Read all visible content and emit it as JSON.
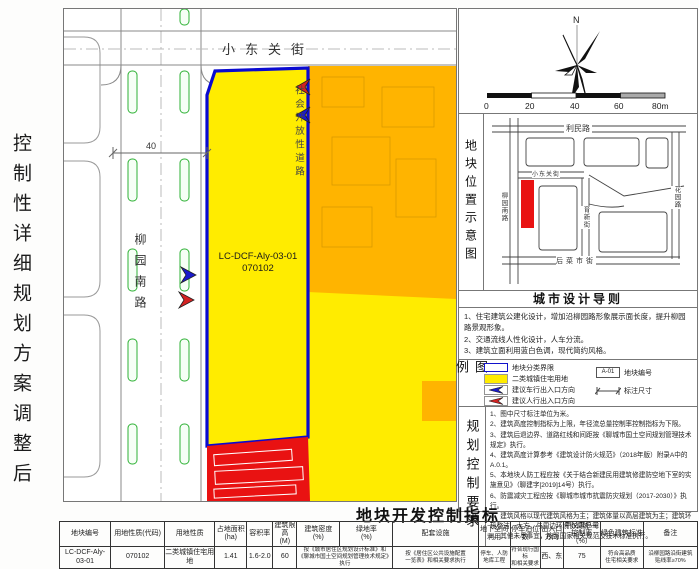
{
  "side_title": "控制性详细规划方案调整后",
  "map": {
    "street_top": "小东关街",
    "road_left": "柳园南路",
    "road_open": "社会开放性道路",
    "parcel_code": "LC-DCF-Aly-03-01",
    "parcel_subcode": "070102",
    "dimension": "40"
  },
  "compass": {
    "north": "N",
    "scale_ticks": [
      "0",
      "20",
      "40",
      "60",
      "80m"
    ]
  },
  "location_map": {
    "section_title": "地块位置示意图",
    "roads": {
      "limin": "利民路",
      "liuyuan": "柳园南路",
      "xiaodongguan": "小东关街",
      "yuxin": "育新街",
      "huayuan": "花园路",
      "houcaishi": "后菜市街"
    }
  },
  "design_guidelines": {
    "title": "城市设计导则",
    "items": [
      "1、住宅建筑公建化设计，增加沿柳园路形象展示面长度，提升柳园路景观形象。",
      "2、交通流线人性化设计，人车分流。",
      "3、建筑立面利用蓝白色调，现代简约风格。"
    ]
  },
  "legend": {
    "label": "图例",
    "items": [
      "地块分类界限",
      "二类城镇住宅用地",
      "建议车行出入口方向",
      "建议人行出入口方向"
    ],
    "parcel_no_symbol": "A-01",
    "parcel_no_label": "地块编号",
    "dim_label": "标注尺寸"
  },
  "planning_control": {
    "label": "规划控制要求",
    "items": [
      "1、图中尺寸标注单位为米。",
      "2、建筑高度控制指标为上限，年径流总量控制率控制指标为下限。",
      "3、建筑后退边界、道路红线和间距按《聊城市国土空间规划管理技术规定》执行。",
      "4、建筑高度计算参考《建筑设计防火规范》（2018年版）附录A中的A.0.1。",
      "5、本地块人防工程应按《关于结合新建民用建筑修建防空地下室的实施意见》（聊建字[2019]14号）执行。",
      "6、防震减灾工程应按《聊城市城市抗震防灾规划（2017-2030）》执行。",
      "7、建筑风格以现代建筑风格为主；建筑体量以高层建筑为主；建筑环境整洁、大方，与周边环境协调统一。",
      "8、其他未尽事宜，按照国家相关规范及技术标准执行。"
    ]
  },
  "dev_table": {
    "title": "地块开发控制指标",
    "headers": [
      "地块编号",
      "用地性质(代码)",
      "用地性质",
      "占地面积\n(ha)",
      "容积率",
      "建筑限高\n(M)",
      "建筑密度\n(%)",
      "绿地率\n(%)",
      "配套设施",
      "地下空间\n利用",
      "停车泊位数",
      "出入口\n方向",
      "年径流总量\n控制率（%）",
      "绿色建筑标准",
      "备注"
    ],
    "row": [
      "LC-DCF-Aly-03-01",
      "070102",
      "二类城镇住宅用地",
      "1.41",
      "1.6-2.0",
      "60",
      "按《城市居住区规划设计标准》和\n《聊城市国土空间规划管理技术规定》执行",
      "按《居住区公共设施配置\n一览表》和相关要求执行",
      "停车、人防\n地库工程",
      "符合现行国标\n和相关要求",
      "西、东",
      "75",
      "符合高品质\n住宅相关要求",
      "沿柳园路沿街建筑\n贴线率≥70%"
    ]
  },
  "colors": {
    "residential_yellow": "#ffec00",
    "adjacent_orange": "#ffb400",
    "demolition_red": "#e91212",
    "boundary_blue": "#0a0ad0"
  }
}
